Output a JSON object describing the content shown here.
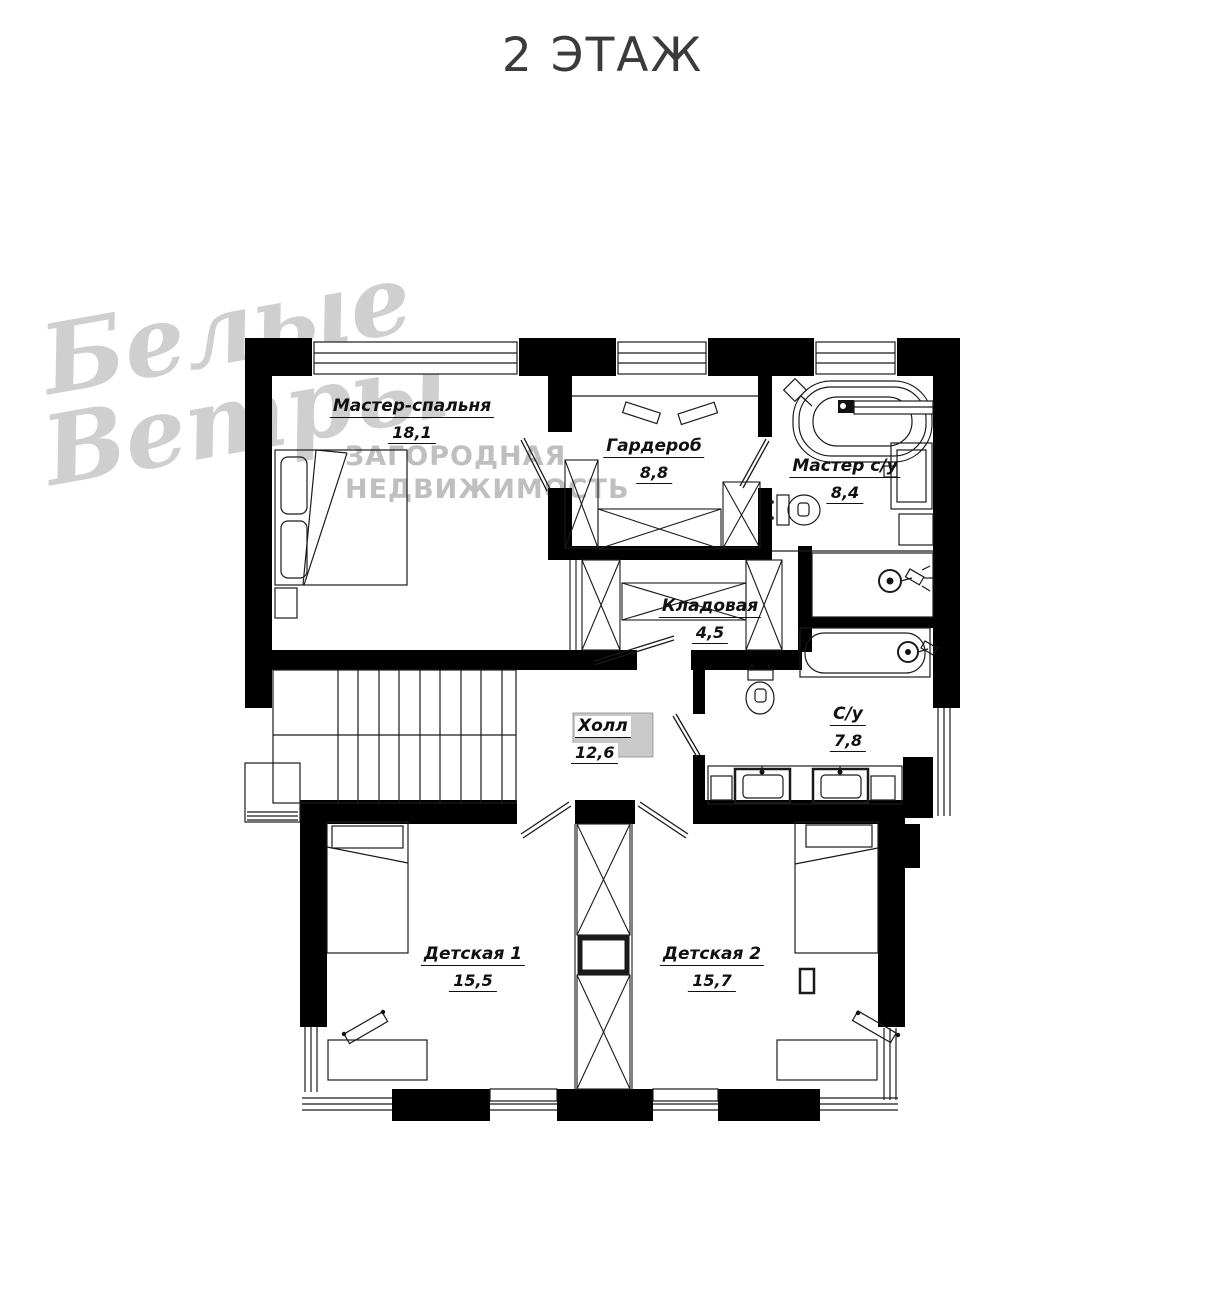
{
  "title": "2 ЭТАЖ",
  "watermark": {
    "script_line1": "Белые",
    "script_line2": "Ветры",
    "caption_line1": "ЗАГОРОДНАЯ",
    "caption_line2": "НЕДВИЖИМОСТЬ"
  },
  "rooms": [
    {
      "id": "master-bedroom",
      "name": "Мастер-спальня",
      "area": "18,1"
    },
    {
      "id": "wardrobe",
      "name": "Гардероб",
      "area": "8,8"
    },
    {
      "id": "master-bath",
      "name": "Мастер с/у",
      "area": "8,4"
    },
    {
      "id": "storage",
      "name": "Кладовая",
      "area": "4,5"
    },
    {
      "id": "hall",
      "name": "Холл",
      "area": "12,6"
    },
    {
      "id": "bath",
      "name": "С/у",
      "area": "7,8"
    },
    {
      "id": "kids-room-1",
      "name": "Детская 1",
      "area": "15,5"
    },
    {
      "id": "kids-room-2",
      "name": "Детская 2",
      "area": "15,7"
    }
  ],
  "colors": {
    "wall": "#000000",
    "line": "#1a1a1a",
    "hall_rect": "#c9c9c9",
    "watermark": "#c7c7c7",
    "title": "#3b3b3b"
  }
}
